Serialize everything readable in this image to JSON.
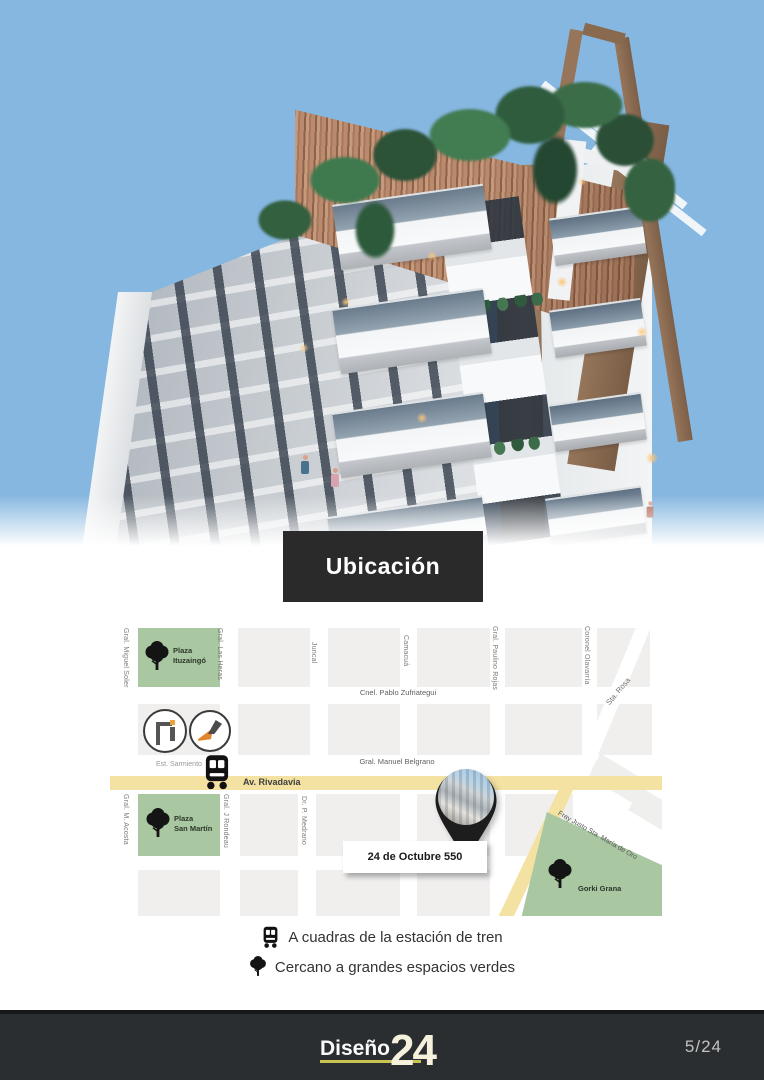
{
  "banner": {
    "title": "Ubicación"
  },
  "map": {
    "streets_vertical": [
      "Gral. Miguel Soler",
      "Gral. Las Heras",
      "Juncal",
      "Camacuá",
      "Gral. Paulino Rojas",
      "Coronel Olavarría",
      "Gral. M. Acosta",
      "Gral. J Rondeau",
      "Dr. P. Medrano"
    ],
    "streets_horizontal": [
      "Cnel. Pablo Zufriategui",
      "Gral. Manuel Belgrano",
      "Av. Rivadavia"
    ],
    "streets_diagonal": [
      "Sta. Rosa",
      "Fray Justo Sta. María de Oro"
    ],
    "station_label": "Est. Sarmiento",
    "parks": [
      {
        "label": "Plaza\nItuzaingó"
      },
      {
        "label": "Plaza\nSan Martín"
      },
      {
        "label": "Gorki Grana"
      }
    ],
    "pin_label": "24 de Octubre 550",
    "icons": [
      "train-icon",
      "tree-icon",
      "map-pin",
      "brand-logo-1",
      "brand-logo-2"
    ],
    "colors": {
      "road_yellow": "#f3e2a2",
      "park_green": "#a9c7a1",
      "block_gray": "#f0efee"
    }
  },
  "features": [
    {
      "icon": "train-icon",
      "text": "A cuadras de la estación de tren"
    },
    {
      "icon": "tree-icon",
      "text": "Cercano a grandes espacios verdes"
    }
  ],
  "footer": {
    "brand_text": "Diseño",
    "brand_number": "24",
    "page_indicator": "5/24",
    "colors": {
      "bar": "#2b2e30",
      "underline": "#c9c352",
      "banner": "#2b2a2a"
    }
  }
}
